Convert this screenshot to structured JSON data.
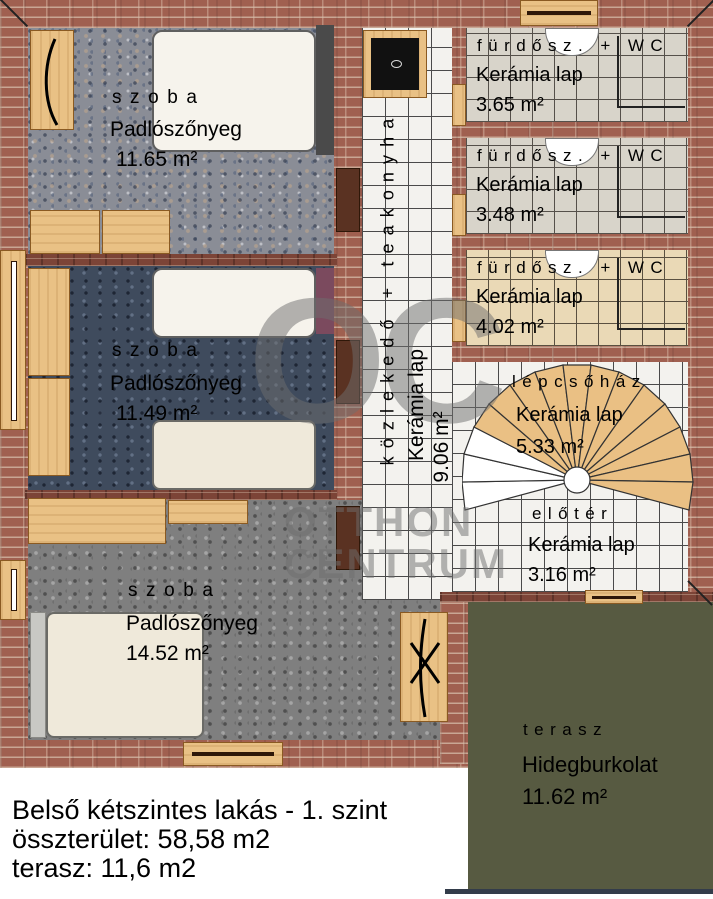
{
  "plan": {
    "rooms": {
      "szoba1": {
        "name": "szoba",
        "material": "Padlószőnyeg",
        "area": "11.65 m²"
      },
      "szoba2": {
        "name": "szoba",
        "material": "Padlószőnyeg",
        "area": "11.49 m²"
      },
      "szoba3": {
        "name": "szoba",
        "material": "Padlószőnyeg",
        "area": "14.52 m²"
      },
      "kozlekedo": {
        "name": "közlekedő + teakonyha",
        "material": "Kerámia lap",
        "area": "9.06 m²"
      },
      "furdo1": {
        "name": "fürdősz. + WC",
        "material": "Kerámia lap",
        "area": "3.65 m²"
      },
      "furdo2": {
        "name": "fürdősz. + WC",
        "material": "Kerámia lap",
        "area": "3.48 m²"
      },
      "furdo3": {
        "name": "fürdősz. + WC",
        "material": "Kerámia lap",
        "area": "4.02 m²"
      },
      "lepcsohaz": {
        "name": "lépcsőház",
        "material": "Kerámia lap",
        "area": "5.33 m²"
      },
      "eloter": {
        "name": "előtér",
        "material": "Kerámia lap",
        "area": "3.16 m²"
      },
      "terasz": {
        "name": "terasz",
        "material": "Hidegburkolat",
        "area": "11.62 m²"
      }
    },
    "footer": {
      "line1": "Belső kétszintes lakás - 1. szint",
      "line2": "összterület: 58,58 m2",
      "line3": "terasz: 11,6 m2"
    },
    "watermark": {
      "initials": "OC",
      "line1": "OTTHON",
      "line2": "CENTRUM"
    },
    "colors": {
      "brick_wall": "#a06050",
      "terrace_green": "#575a41",
      "carpet_room1": "#8a8d96",
      "carpet_room2": "#3f4b5d",
      "carpet_room3": "#7f7f7f",
      "tile_white": "#f3f2ee",
      "tile_gray": "#d8d4ca",
      "tile_beige": "#ead9b6",
      "wood_furniture": "#e9c185",
      "stair_fill": "#eac084",
      "accent_purple": "#7b4a5e"
    }
  }
}
